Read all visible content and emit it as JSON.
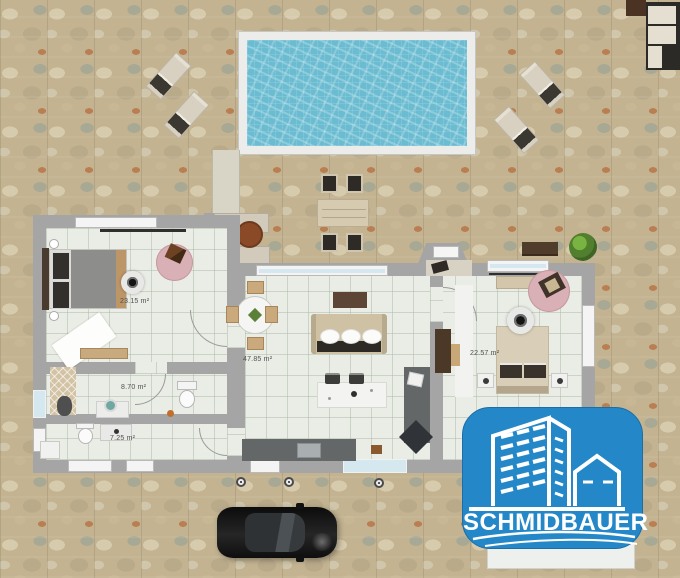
{
  "plan": {
    "rooms": [
      {
        "name": "master-bedroom",
        "area_label": "23.15 m²"
      },
      {
        "name": "living-kitchen",
        "area_label": "47.85 m²"
      },
      {
        "name": "bathroom",
        "area_label": "8.70 m²"
      },
      {
        "name": "wc",
        "area_label": "7.25 m²"
      },
      {
        "name": "second-bedroom",
        "area_label": "22.57 m²"
      }
    ],
    "objects": {
      "outdoor": [
        "swimming-pool",
        "sun-lounger",
        "sun-lounger",
        "sun-lounger",
        "sun-lounger",
        "outdoor-dining-table",
        "outdoor-chairs",
        "outdoor-corner-sofa",
        "side-table",
        "round-table",
        "garden-benches",
        "potted-plant",
        "wooden-bench",
        "ground-lamps",
        "car"
      ],
      "indoor": [
        "double-bed",
        "ceiling-fan",
        "round-rug-with-chair",
        "white-rug",
        "bench",
        "shower",
        "vanity-with-mirror",
        "toilet",
        "toilet",
        "sink-vanity",
        "round-dining-table",
        "dining-chairs",
        "sofa-with-pillows",
        "media-console",
        "kitchen-island",
        "bar-stools",
        "kitchen-counter",
        "stove",
        "wardrobe",
        "double-bed-2",
        "nightstands",
        "foot-bench",
        "ceiling-fan-2",
        "round-rug-with-chair-2"
      ]
    }
  },
  "logo": {
    "text": "SCHMIDBAUER",
    "icon": "building-logo-icon",
    "bg_color": "#2487c8",
    "text_color": "#ffffff"
  },
  "colors": {
    "ground_stone": "#c3b391",
    "pool_water": "#6cbcd1",
    "pool_deck": "#ececea",
    "wall_gray": "#a5a5a5",
    "floor_tile": "#e9ede5",
    "rug_pink": "#d9b0b6",
    "logo_blue": "#2487c8"
  }
}
